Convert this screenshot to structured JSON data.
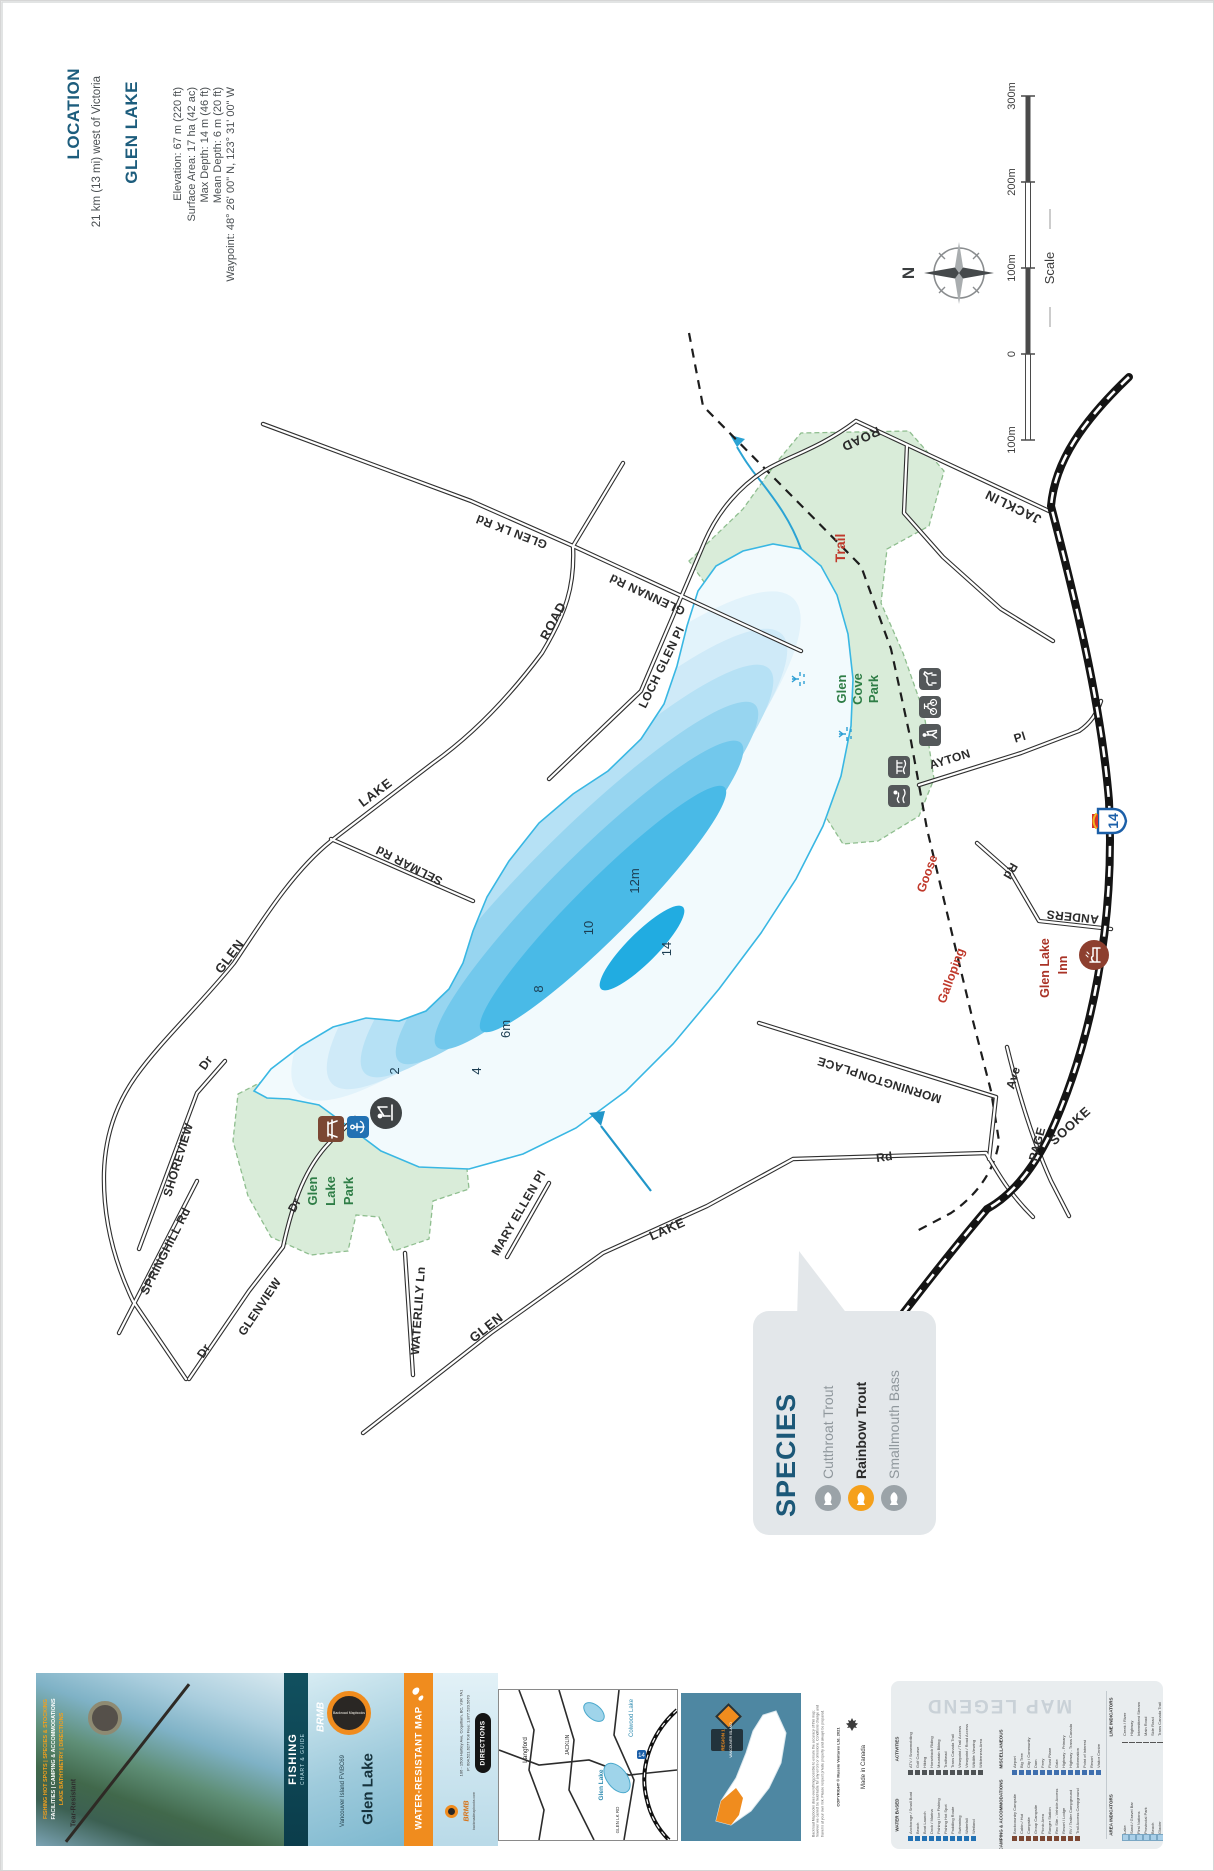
{
  "colors": {
    "accent_orange": "#f08c1e",
    "map_red": "#c0392b",
    "park_green": "#2e7d46",
    "water_blue": "#29b1e3",
    "header_teal": "#1d5d7d",
    "species_highlight": "#f5a01b"
  },
  "header": {
    "location_label": "LOCATION",
    "location_value": "21 km (13 mi) west of Victoria",
    "lake_name": "GLEN LAKE",
    "stats": {
      "elevation": "Elevation: 67 m (220 ft)",
      "surface": "Surface Area: 17 ha (42 ac)",
      "max_depth": "Max Depth: 14 m (46 ft)",
      "mean_depth": "Mean Depth: 6 m (20 ft)",
      "waypoint": "Waypoint: 48° 26' 00\" N, 123° 31' 00\" W"
    }
  },
  "compass": {
    "north": "N"
  },
  "scale_bar": {
    "label": "Scale",
    "l300": "300m",
    "l200": "200m",
    "l100": "100m",
    "l0": "0",
    "l100b": "100m"
  },
  "map": {
    "glen_lk_rd": "GLEN LK Rd",
    "glennan": "GLENNAN Rd",
    "loch_glen": "LOCH GLEN Pl",
    "road_w": "ROAD",
    "lake_w": "LAKE",
    "glen_w": "GLEN",
    "selmar": "SELMAR Rd",
    "shoreview": "SHOREVIEW",
    "shoreview_dr": "Dr",
    "springhill": "SPRINGHILL Rd",
    "glenview": "GLENVIEW",
    "glenview_dr": "Dr",
    "glenview_dr2": "Dr",
    "waterlily": "WATERLILY Ln",
    "glen_s": "GLEN",
    "lake_s": "LAKE",
    "rd_s": "Rd",
    "mary_ellen": "MARY ELLEN Pl",
    "mornington": "MORNINGTON",
    "mornington_place": "PLACE",
    "ayton": "AYTON",
    "ayton_pl": "Pl",
    "anders": "ANDERS",
    "anders_rd": "Rd",
    "sooke": "SOOKE",
    "page": "PAGE",
    "page_ave": "Ave",
    "jacklin": "JACKLIN",
    "jacklin_road": "ROAD",
    "trail": "Trail",
    "goose": "Goose",
    "galloping": "Galloping",
    "gc1": "Glen",
    "gc2": "Cove",
    "gc3": "Park",
    "glp1": "Glen",
    "glp2": "Lake",
    "glp3": "Park",
    "inn1": "Glen Lake",
    "inn2": "Inn",
    "hwy": "14",
    "d2": "2",
    "d4": "4",
    "d6": "6m",
    "d8": "8",
    "d10": "10",
    "d12": "12m",
    "d14": "14",
    "depth_contours_m": [
      2,
      4,
      6,
      8,
      10,
      12,
      14
    ]
  },
  "species": {
    "title": "SPECIES",
    "items": [
      {
        "name": "Cutthroat Trout",
        "highlight": false
      },
      {
        "name": "Rainbow Trout",
        "highlight": true
      },
      {
        "name": "Smallmouth Bass",
        "highlight": false
      }
    ]
  },
  "footer": {
    "cover": {
      "tear": "Tear-Resistant",
      "f1": "FISHING HOT SPOTS | SPECIES & STOCKING",
      "f2": "FACILITIES | CAMPING & ACCOMMODATIONS",
      "f3": "LAKE BATHYMETRY | DIRECTIONS"
    },
    "series": {
      "brmb": "BRMB",
      "fishing": "FISHING",
      "sub": "CHART & GUIDE"
    },
    "title_panel": {
      "brand": "Backroad Mapbooks",
      "title": "Glen Lake",
      "subtitle": "Vancouver Island FVIBC69"
    },
    "banner": "WATER-RESISTANT MAP",
    "contact": {
      "brand": "BRMB",
      "web": "backroadmapbooks.com",
      "address": "106 - 1500 Hartley Ave, Coquitlam, BC, V3K 7A1",
      "phone": "P: 604.521.6277   Toll Free: 1.877.520.5670",
      "directions": "DIRECTIONS"
    },
    "inset": {
      "colwood": "Colwood Lake",
      "langford": "Langford",
      "glen_lake": "Glen Lake",
      "jacklin": "JACKLIN",
      "glen_lk_rd": "GLEN LK RD",
      "hwy": "14"
    },
    "region": {
      "line1": "REGION 1",
      "line2": "VANCOUVER ISLAND"
    },
    "disclaimer": "Backroad Mapbooks does everything possible to ensure the accuracy of this map; however we cannot be held liable for any errors or omissions. Conditions change and travel is at your own risk. Please respect private property and always be prepared.",
    "copyright": "COPYRIGHT © Mussio Ventures Ltd. 2021",
    "made_in": "Made in Canada"
  },
  "legend": {
    "title": "MAP LEGEND",
    "sections": [
      {
        "name": "ACTIVITIES",
        "items": [
          "ATV / Snowmobiling",
          "Golf Course",
          "Hiking",
          "Horseback Riding",
          "Mountain Biking",
          "Trailhead",
          "Trans Canada Trail",
          "Viewpoint / Trail Access",
          "Viewpoint / Road Access",
          "Wildlife Viewing",
          "Wilderness Area"
        ]
      },
      {
        "name": "MISCELLANEOUS",
        "items": [
          "Airport",
          "Big Tree",
          "City / Community",
          "Dam",
          "Ferry",
          "Float Plane",
          "Gate",
          "Highway - Primary",
          "Highway - Trans Canada",
          "Information",
          "Point of Interest",
          "Resort",
          "Visitor Centre"
        ]
      },
      {
        "name": "WATER BASED",
        "items": [
          "Anchorage / Small Boat",
          "Beach",
          "Boat Launch",
          "Dock / Marina",
          "Fishing / Ice Fishing",
          "Fishing Hot Spot",
          "Paddling Route",
          "Swimming",
          "Waterfall",
          "Wetland"
        ]
      },
      {
        "name": "CAMPING & ACCOMMODATIONS",
        "items": [
          "Backcountry Campsite",
          "Cabin / Hut",
          "Campsite",
          "Group Campsite",
          "Picnic Area",
          "Ranger Station",
          "Rec Site - Vehicle Access",
          "Resort / Lodge",
          "RV / Trailer Campground",
          "Trail Access Campground"
        ]
      },
      {
        "name": "LINE INDICATORS",
        "items": [
          "Creek / River",
          "Highway",
          "Intermittent Stream",
          "Main Road",
          "Side Road",
          "Trans Canada Trail",
          "Trail / Old Road",
          "Railway",
          "Management Unit"
        ]
      },
      {
        "name": "AREA INDICATORS",
        "items": [
          "Lake",
          "Sand / Gravel Bar",
          "First Nations",
          "Provincial Park",
          "Beach",
          "Glacier",
          "Swamp / Marsh"
        ]
      }
    ]
  }
}
